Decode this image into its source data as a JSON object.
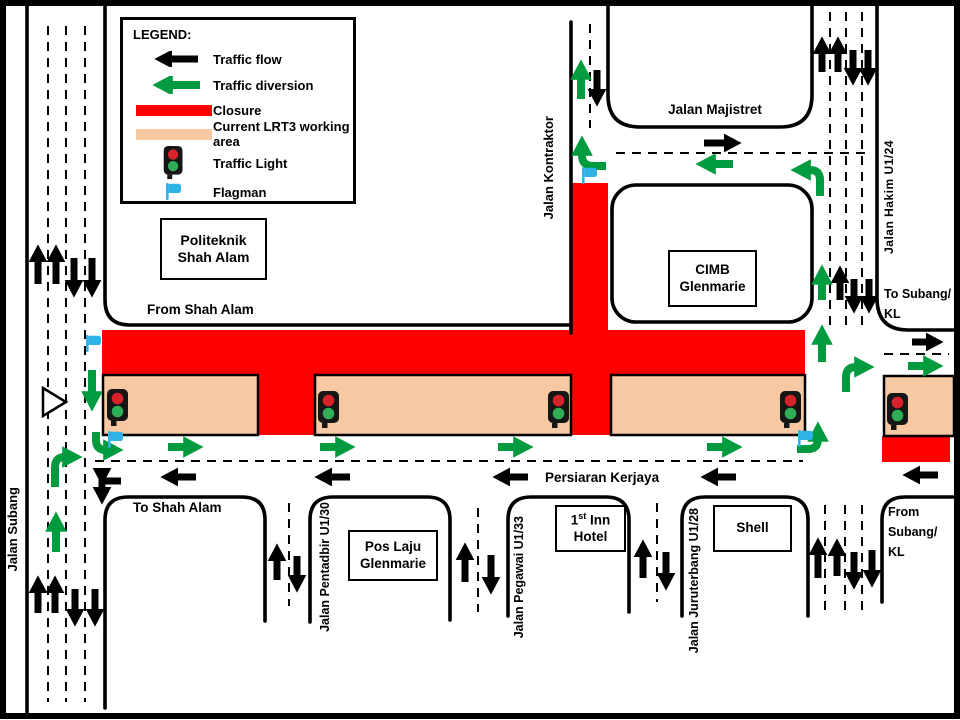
{
  "colors": {
    "closure_red": "#fe0000",
    "working_area_peach": "#f6c9a2",
    "diversion_green": "#019b3f",
    "traffic_flow_black": "#000000",
    "flagman_blue": "#2fb2e6",
    "light_red": "#d8232a",
    "light_green": "#2fae56"
  },
  "legend": {
    "title": "LEGEND:",
    "items": [
      {
        "label": "Traffic flow",
        "icon": "black-arrow"
      },
      {
        "label": "Traffic diversion",
        "icon": "green-arrow"
      },
      {
        "label": "Closure",
        "icon": "red-bar"
      },
      {
        "label": "Current LRT3 working area",
        "icon": "peach-bar"
      },
      {
        "label": "Traffic Light",
        "icon": "traffic-light"
      },
      {
        "label": "Flagman",
        "icon": "flagman-flag"
      }
    ]
  },
  "roads": {
    "jalan_subang": "Jalan Subang",
    "jalan_kontraktor": "Jalan Kontraktor",
    "jalan_majistret": "Jalan Majistret",
    "jalan_hakim": "Jalan Hakim U1/24",
    "persiaran_kerjaya": "Persiaran Kerjaya",
    "jalan_pentadbir": "Jalan Pentadbir U1/30",
    "jalan_pegawai": "Jalan Pegawai U1/33",
    "jalan_juruterbang": "Jalan Juruterbang U1/28"
  },
  "places": {
    "politeknik_line1": "Politeknik",
    "politeknik_line2": "Shah Alam",
    "cimb_line1": "CIMB",
    "cimb_line2": "Glenmarie",
    "poslaju_line1": "Pos Laju",
    "poslaju_line2": "Glenmarie",
    "hotel_num": "1",
    "hotel_sup": "st",
    "hotel_rest": " Inn",
    "hotel_line2": "Hotel",
    "shell": "Shell"
  },
  "directions": {
    "from_shah_alam": "From Shah Alam",
    "to_shah_alam": "To Shah Alam",
    "to_subang_line1": "To Subang/",
    "to_subang_line2": "KL",
    "from_subang_line1": "From",
    "from_subang_line2": "Subang/",
    "from_subang_line3": "KL"
  }
}
